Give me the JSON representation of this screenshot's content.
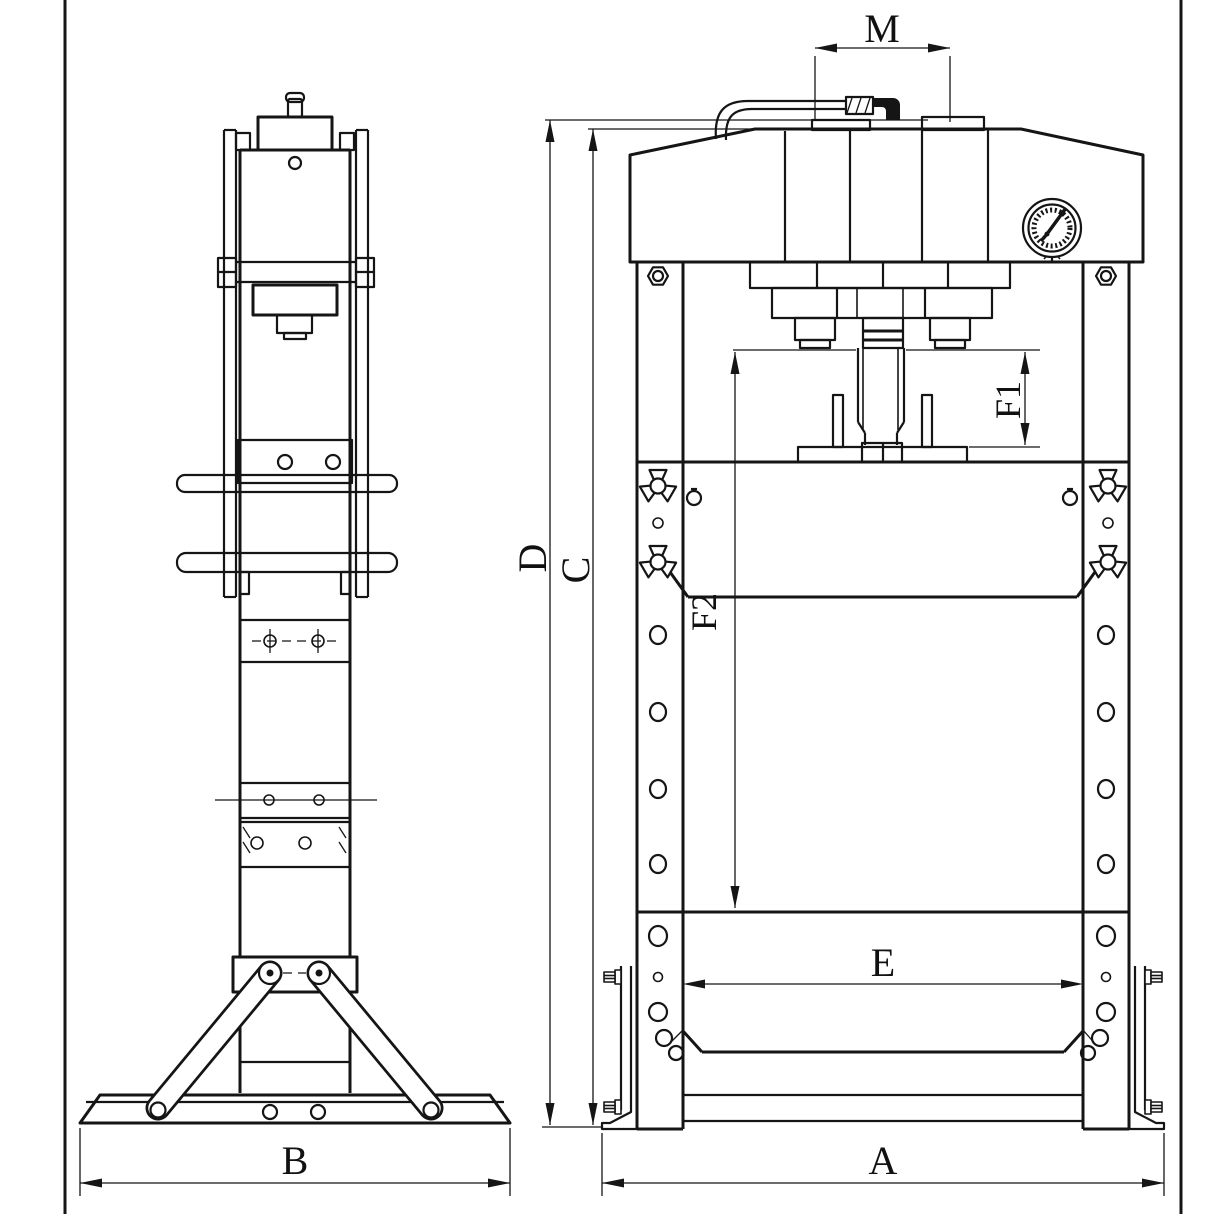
{
  "drawing": {
    "kind": "hydraulic shop press - two view engineering drawing",
    "views": {
      "side": "side-view",
      "front": "front-view"
    }
  },
  "colors": {
    "line": "#151515",
    "background": "#ffffff",
    "label": "#111111"
  },
  "dimension_labels": {
    "a": "A",
    "b": "B",
    "c": "C",
    "d": "D",
    "e": "E",
    "f1": "F1",
    "f2": "F2",
    "m": "M"
  }
}
